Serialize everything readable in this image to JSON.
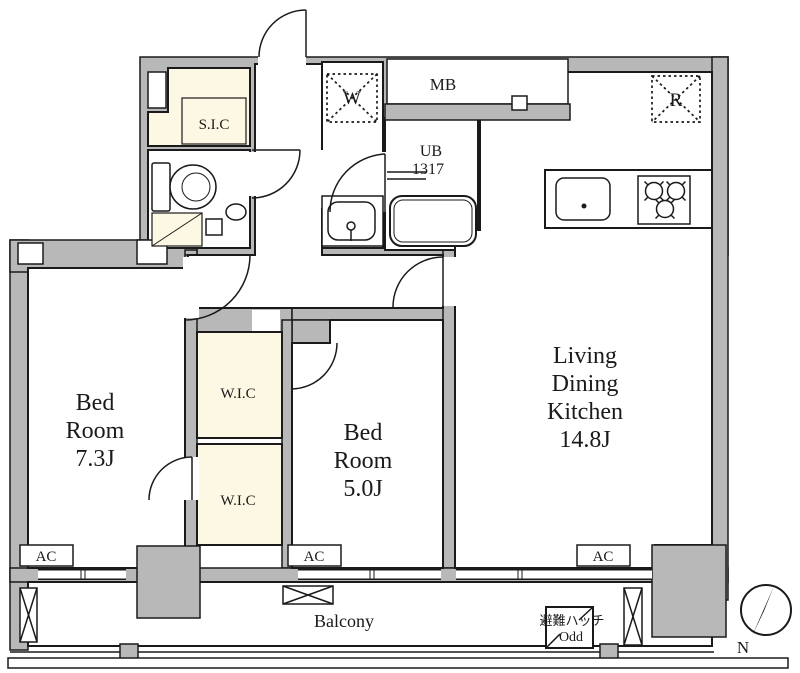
{
  "rooms": {
    "ldk": {
      "lines": [
        "Living",
        "Dining",
        "Kitchen",
        "14.8J"
      ]
    },
    "bedroom1": {
      "lines": [
        "Bed",
        "Room",
        "7.3J"
      ]
    },
    "bedroom2": {
      "lines": [
        "Bed",
        "Room",
        "5.0J"
      ]
    },
    "wic_upper": {
      "label": "W.I.C"
    },
    "wic_lower": {
      "label": "W.I.C"
    },
    "sic": {
      "label": "S.I.C"
    },
    "unit_bath": {
      "lines": [
        "UB",
        "1317"
      ]
    },
    "meter_box": {
      "label": "MB"
    },
    "balcony": {
      "label": "Balcony"
    }
  },
  "appliances": {
    "washer": "W",
    "refrigerator": "R",
    "air_conditioner": "AC"
  },
  "annotations": {
    "evacuation_hatch": "避難ハッチ",
    "evacuation_hatch_note": "Odd",
    "compass_north": "N"
  },
  "colors": {
    "wall_fill": "#b8b8b8",
    "closet_fill": "#fcf8e3",
    "line": "#1a1a1a",
    "floor": "#ffffff"
  }
}
